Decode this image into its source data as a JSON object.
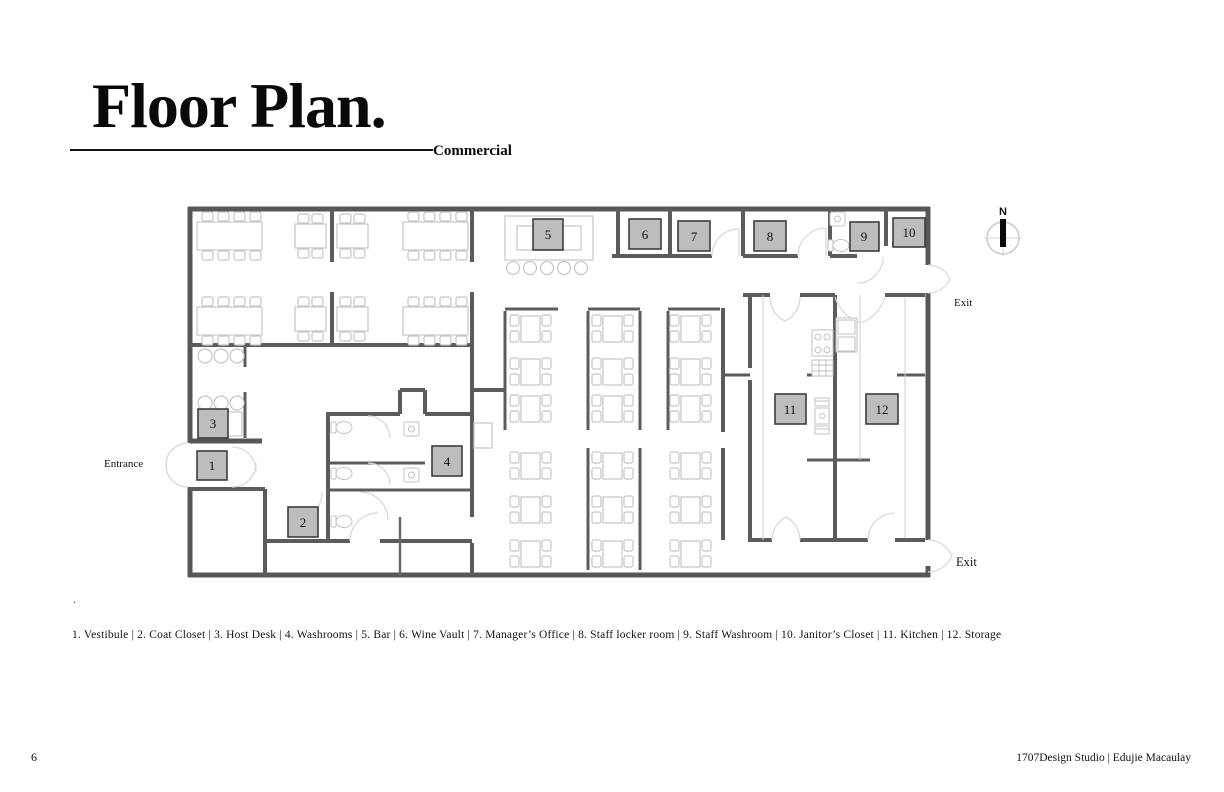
{
  "page": {
    "title": "Floor Plan.",
    "subtitle": "Commercial",
    "stray_dot": ".",
    "page_number": "6",
    "credit": "1707Design Studio | Edujie Macaulay"
  },
  "plan": {
    "entrance_label": "Entrance",
    "exit_top_label": "Exit",
    "exit_bottom_label": "Exit",
    "compass_north": "N"
  },
  "legend": {
    "separator": "|",
    "items": [
      {
        "number": "1",
        "name": "Vestibule"
      },
      {
        "number": "2",
        "name": "Coat Closet"
      },
      {
        "number": "3",
        "name": "Host Desk"
      },
      {
        "number": "4",
        "name": "Washrooms"
      },
      {
        "number": "5",
        "name": "Bar"
      },
      {
        "number": "6",
        "name": "Wine Vault"
      },
      {
        "number": "7",
        "name": "Manager’s Office"
      },
      {
        "number": "8",
        "name": "Staff locker room"
      },
      {
        "number": "9",
        "name": "Staff Washroom"
      },
      {
        "number": "10",
        "name": "Janitor’s Closet"
      },
      {
        "number": "11",
        "name": "Kitchen"
      },
      {
        "number": "12",
        "name": "Storage"
      }
    ]
  },
  "colors": {
    "wall": "#575757",
    "furniture": "#c6c6c6",
    "door_swing": "#d9d9d9",
    "room_label_fill": "#bdbdbd",
    "room_label_border": "#3d3d3d",
    "text": "#111111"
  }
}
